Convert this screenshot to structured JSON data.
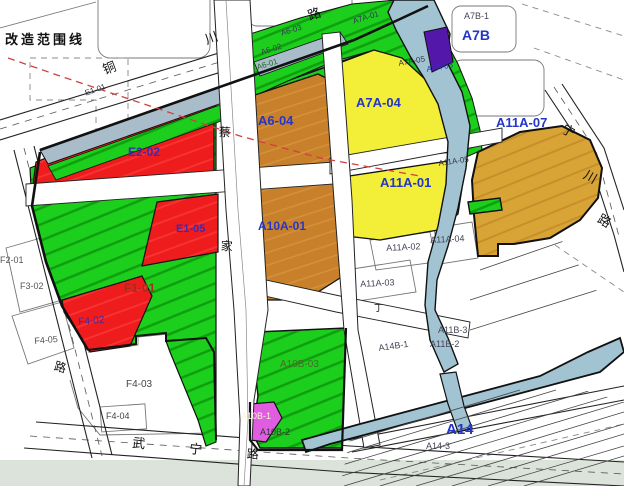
{
  "scope_label": "改造范围线",
  "parcels": {
    "e1_01": "E1-01",
    "e2_02": "E2-02",
    "e1_05": "E1-05",
    "f1_01": "F1-01",
    "f2_01": "F2-01",
    "f3_02": "F3-02",
    "f4_02": "F4-02",
    "f4_03": "F4-03",
    "f4_04": "F4-04",
    "f4_05": "F4-05",
    "a6_01": "A6-01",
    "a6_02": "A6-02",
    "a6_03": "A6-03",
    "a6_04": "A6-04",
    "a7a_01": "A7A-01",
    "a7a_03": "A7A-03",
    "a7a_04": "A7A-04",
    "a7a_05": "A7A-05",
    "a7b": "A7B",
    "a7b_1": "A7B-1",
    "a10a_01": "A10A-01",
    "a10b_01": "A10B-1",
    "a10b_02": "A10B-2",
    "a10b_03": "A10B-03",
    "a11a_01": "A11A-01",
    "a11a_02": "A11A-02",
    "a11a_03": "A11A-03",
    "a11a_04": "A11A-04",
    "a11a_05": "A11A-05",
    "a11a_07": "A11A-07",
    "a11b_2": "A11B-2",
    "a11b_3": "A11B-3",
    "a14": "A14",
    "a14_3": "A14-3",
    "a14b_1": "A14B-1"
  },
  "roads": {
    "tongchuan": [
      "铜",
      "川",
      "路"
    ],
    "center": [
      "蔡",
      "家",
      "路"
    ],
    "wuning": [
      "武",
      "宁"
    ],
    "ningchuan": [
      "宁",
      "川",
      "路"
    ],
    "west": [
      "路"
    ],
    "minor": [
      "丁"
    ]
  },
  "colors": {
    "residential_red": "#ee1c1c",
    "green_space": "#1dcf1d",
    "green_hatch": "#0fa00f",
    "yellow_parcel": "#f3ee38",
    "orange_parcel": "#c9802b",
    "gold_parcel": "#d8a435",
    "purple_parcel": "#5318aa",
    "magenta_parcel": "#e05ce0",
    "water": "#a2c4d2",
    "gray_strip": "#a9bcc9",
    "label_blue": "#2436c8",
    "label_maroon": "#a03020",
    "scope_line_red": "#cf4040"
  }
}
